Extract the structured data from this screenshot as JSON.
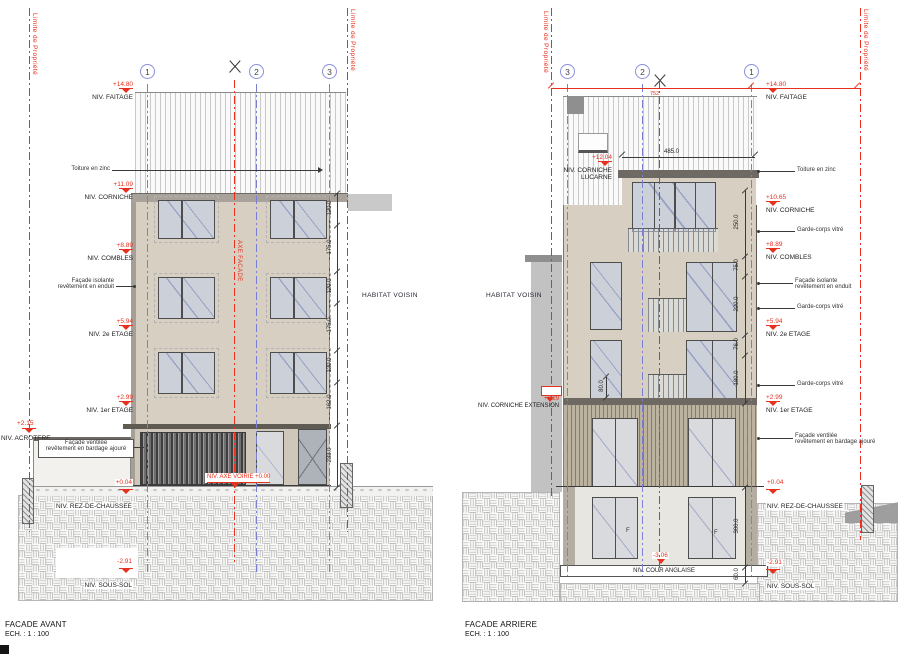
{
  "front": {
    "title": "FACADE AVANT",
    "scale": "ECH. :  1 : 100",
    "property_line": "Limite de Propriété",
    "grids": [
      "1",
      "2",
      "3"
    ],
    "axis_label": "AXE FACADE",
    "road_axis_label": "NIV. AXE VOIRIE +0.00",
    "neighbor": "HABITAT VOISIN",
    "roof_note": "Toiture en zinc",
    "note_isolante_1": "Façade isolante",
    "note_isolante_2": "revêtement en enduit",
    "note_ventilee_1": "Façade ventilée",
    "note_ventilee_2": "revêtement en bardage ajouré",
    "levels": {
      "faitage": {
        "v": "+14.80",
        "l": "NIV. FAITAGE"
      },
      "corniche": {
        "v": "+11.09",
        "l": "NIV. CORNICHE"
      },
      "combles": {
        "v": "+8.89",
        "l": "NIV. COMBLES"
      },
      "etage2": {
        "v": "+5.94",
        "l": "NIV. 2e ETAGE"
      },
      "etage1": {
        "v": "+2.99",
        "l": "NIV. 1er ETAGE"
      },
      "acrotere": {
        "v": "+2.15",
        "l": "NIV. ACROTERE"
      },
      "rdc": {
        "v": "+0.04",
        "l": "NIV. REZ-DE-CHAUSSEE"
      },
      "soussol": {
        "v": "-2.91",
        "l": "NIV. SOUS-SOL"
      }
    },
    "dims": [
      "120.0",
      "175.0",
      "120.0",
      "175.0",
      "120.0",
      "162.0",
      "233.0"
    ]
  },
  "rear": {
    "title": "FACADE ARRIERE",
    "scale": "ECH. :  1 : 100",
    "property_line": "Limite de Propriété",
    "grids": [
      "3",
      "2",
      "1"
    ],
    "axis_dim": "752",
    "neighbor": "HABITAT VOISIN",
    "roof_note": "Toiture en zinc",
    "garde_corps": "Garde-corps vitré",
    "note_isolante_1": "Façade isolante",
    "note_isolante_2": "revêtement en enduit",
    "note_ventilee_1": "Façade ventilée",
    "note_ventilee_2": "revêtement en bardage ajouré",
    "window_tag": "F",
    "levels": {
      "faitage": {
        "v": "+14.80",
        "l": "NIV. FAITAGE"
      },
      "lucarne": {
        "v": "+12.04",
        "l1": "NIV. CORNICHE",
        "l2": "LUCARNE"
      },
      "corniche": {
        "v": "+10.65",
        "l": "NIV. CORNICHE"
      },
      "combles": {
        "v": "+8.89",
        "l": "NIV. COMBLES"
      },
      "etage2": {
        "v": "+5.94",
        "l": "NIV. 2e ETAGE"
      },
      "etage1": {
        "v": "+2.99",
        "l": "NIV. 1er ETAGE"
      },
      "extension": {
        "v": "+3.29",
        "l": "NIV. CORNICHE EXTENSION"
      },
      "rdc": {
        "v": "+0.04",
        "l": "NIV. REZ-DE-CHAUSSEE"
      },
      "cour": {
        "v": "-3.06",
        "l": "NIV. COUR ANGLAISE"
      },
      "soussol": {
        "v": "-2.91",
        "l": "NIV. SOUS-SOL"
      }
    },
    "dim_top": "485.0",
    "dim_left": "80.0",
    "dims_right": [
      "250.0",
      "75.0",
      "220.0",
      "76.0",
      "180.0"
    ],
    "dims_bottom": [
      "300.0",
      "60.0"
    ]
  },
  "colors": {
    "red": "#e8301e",
    "blue": "#7a7fd6",
    "facade": "#d7d0c2"
  }
}
